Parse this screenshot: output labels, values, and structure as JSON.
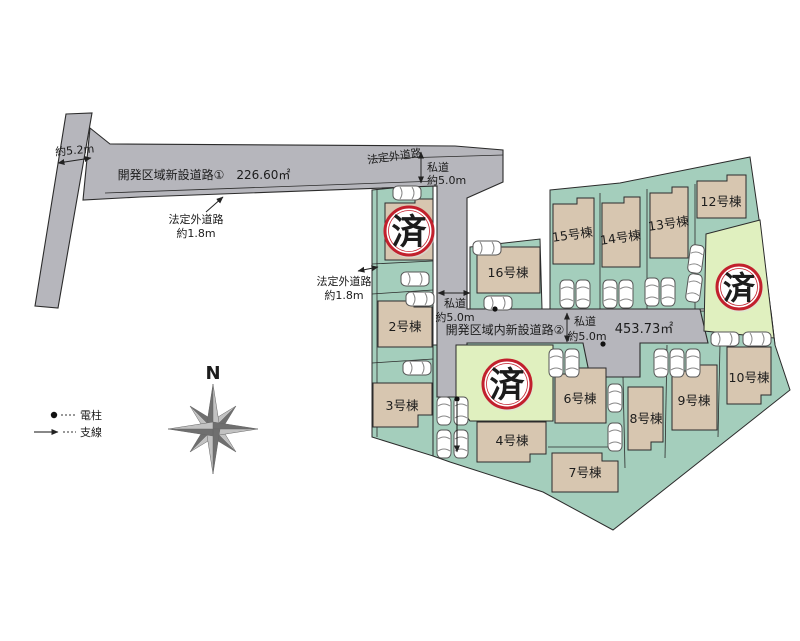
{
  "colors": {
    "site_green": "#a4cebc",
    "sold_yellow": "#e0f0bf",
    "building": "#d7c6b0",
    "road": "#b6b6bc",
    "stamp_red": "#c2202d",
    "compass_dark": "#6f6f6f",
    "compass_light": "#c2c2c2"
  },
  "map": {
    "roads": {
      "road1_label": "開発区域新設道路①　226.60㎡",
      "road2_label": "開発区域内新設道路②",
      "road2_area": "453.73㎡"
    },
    "dims": {
      "w52": "約5.2m",
      "hodo": "法定外道路",
      "hodo_w": "約1.8m",
      "shido": "私道",
      "shido_w": "約5.0m"
    },
    "stamp": "済",
    "compass_n": "N",
    "legend": {
      "pole": "電柱",
      "wire": "支線"
    },
    "lots": [
      {
        "label": "2号棟"
      },
      {
        "label": "3号棟"
      },
      {
        "label": "4号棟"
      },
      {
        "label": "6号棟"
      },
      {
        "label": "7号棟"
      },
      {
        "label": "8号棟"
      },
      {
        "label": "9号棟"
      },
      {
        "label": "10号棟"
      },
      {
        "label": "12号棟"
      },
      {
        "label": "13号棟"
      },
      {
        "label": "14号棟"
      },
      {
        "label": "15号棟"
      },
      {
        "label": "16号棟"
      }
    ]
  }
}
